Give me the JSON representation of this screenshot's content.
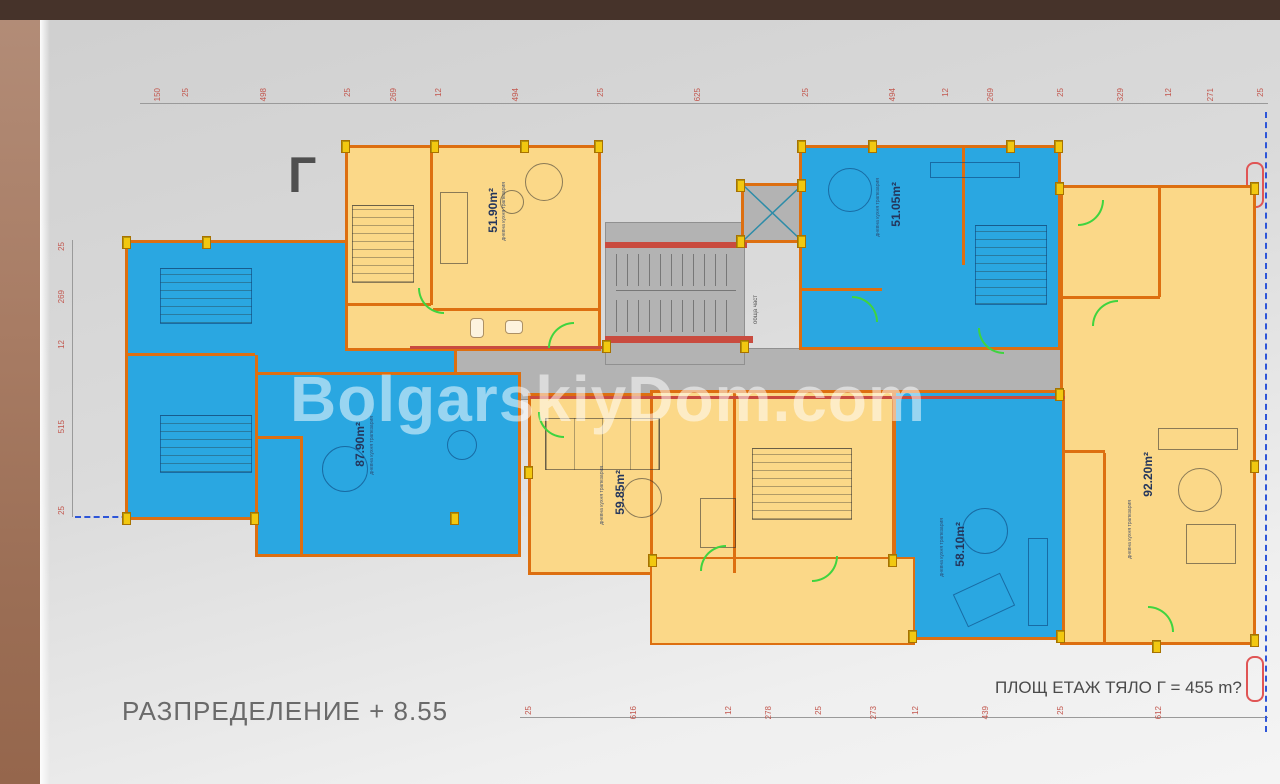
{
  "chrome": {
    "top_bar_color": "#46332a",
    "side_strip_color": "#a87c64"
  },
  "plan": {
    "section_letter": "Г",
    "watermark": "BolgarskiyDom.com",
    "bottom_title": "РАЗПРЕДЕЛЕНИЕ + 8.55",
    "area_note": "ПЛОЩ ЕТАЖ ТЯЛО Г = 455 m?",
    "common_area_label": "обща част",
    "apartments": [
      {
        "name": "apartment-51-90",
        "area": "51.90m²",
        "room": "дневна кухня трапезария",
        "fill": "yellow"
      },
      {
        "name": "apartment-51-05",
        "area": "51.05m²",
        "room": "дневна кухня трапезария",
        "fill": "blue"
      },
      {
        "name": "apartment-87-90",
        "area": "87.90m²",
        "room": "дневна кухня трапезария",
        "fill": "blue"
      },
      {
        "name": "apartment-59-85",
        "area": "59.85m²",
        "room": "дневна кухня трапезария",
        "fill": "yellow"
      },
      {
        "name": "apartment-58-10",
        "area": "58.10m²",
        "room": "дневна кухня трапезария",
        "fill": "blue"
      },
      {
        "name": "apartment-92-20",
        "area": "92.20m²",
        "room": "дневна кухня трапезария",
        "fill": "yellow"
      }
    ],
    "dimensions": {
      "top": [
        "150",
        "25",
        "498",
        "25",
        "269",
        "12",
        "494",
        "25",
        "625",
        "25",
        "494",
        "12",
        "269",
        "25",
        "329",
        "12",
        "271",
        "25"
      ],
      "bottom": [
        "25",
        "616",
        "12",
        "278",
        "25",
        "273",
        "12",
        "439",
        "25",
        "612"
      ],
      "left": [
        "25",
        "269",
        "12",
        "515",
        "25"
      ]
    },
    "colors": {
      "apartment_blue": "#2aa7e1",
      "apartment_yellow": "#fbd888",
      "wall_orange": "#dd6f10",
      "wall_red": "#c94b3f",
      "corridor_gray": "#b3b3b3",
      "dimension_red": "#c2574e",
      "door_green": "#3fd43f",
      "column_yellow": "#f2c810"
    }
  }
}
